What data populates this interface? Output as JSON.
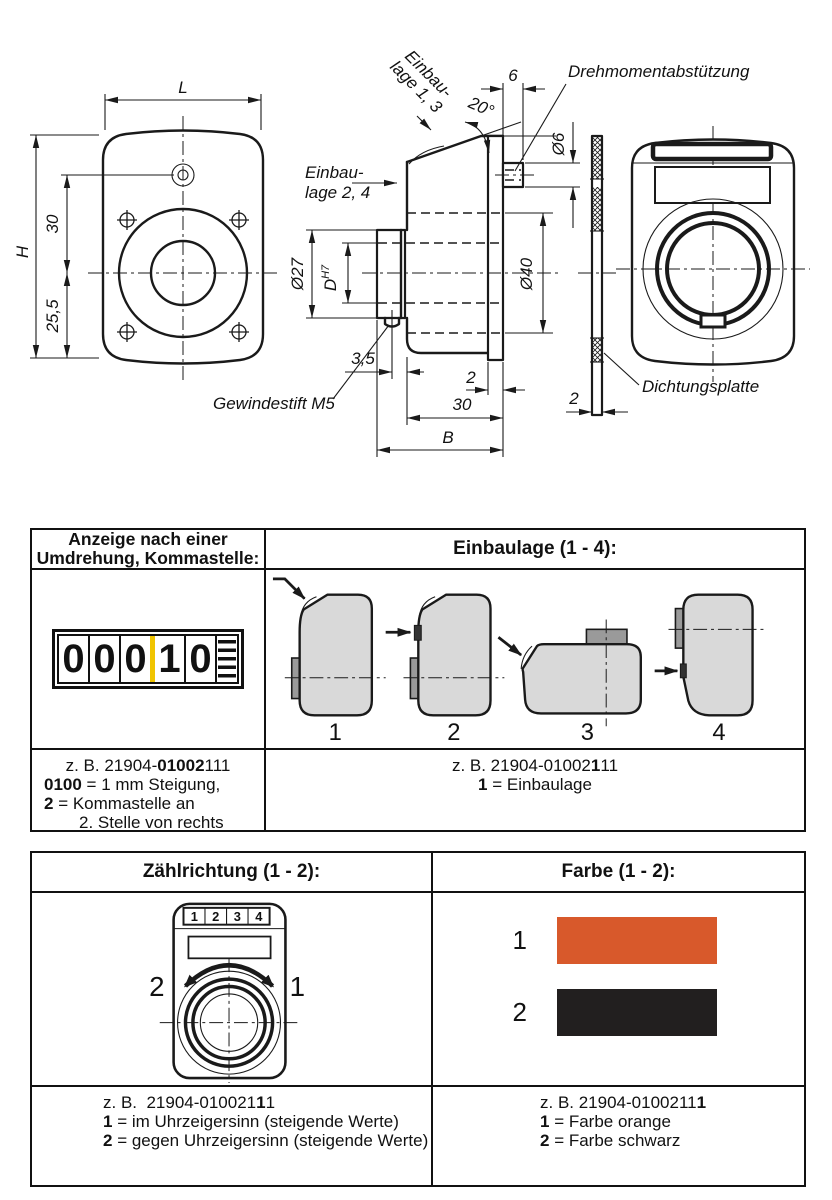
{
  "page": {
    "line_color": "#1a1a1a",
    "background": "#ffffff"
  },
  "drawing": {
    "front": {
      "L": "L",
      "H": "H",
      "d30": "30",
      "d255": "25,5"
    },
    "side": {
      "mount13_l1": "Einbau-",
      "mount13_l2": "lage 1, 3",
      "mount24_l1": "Einbau-",
      "mount24_l2": "lage 2, 4",
      "angle": "20°",
      "w6": "6",
      "torque": "Drehmomentabstützung",
      "d6": "Ø6",
      "d27": "Ø27",
      "D": "D",
      "DH7_sup": "H7",
      "d40": "Ø40",
      "d35": "3,5",
      "setscrew": "Gewindestift M5",
      "t2": "2",
      "d30": "30",
      "B": "B"
    },
    "gasket": {
      "label": "Dichtungsplatte",
      "t2": "2"
    }
  },
  "table1": {
    "header_left_line1": "Anzeige nach einer",
    "header_left_line2": "Umdrehung, Kommastelle:",
    "header_right": "Einbaulage (1 - 4):",
    "counter": {
      "digits": [
        "0",
        "0",
        "0",
        "1",
        "0"
      ],
      "comma_color": "#F0C400"
    },
    "positions": {
      "p1": "1",
      "p2": "2",
      "p3": "3",
      "p4": "4"
    },
    "example_left": {
      "l1a": "z. B. 21904-",
      "l1b": "01002",
      "l1c": "111",
      "l2a": "0100",
      "l2b": " = 1 mm Steigung,",
      "l3a": "2",
      "l3b": " = Kommastelle an",
      "l4": "2. Stelle von rechts"
    },
    "example_right": {
      "l1a": "z. B. 21904-01002",
      "l1b": "1",
      "l1c": "11",
      "l2a": "1",
      "l2b": " = Einbaulage"
    }
  },
  "table2": {
    "header_left": "Zählrichtung (1 - 2):",
    "header_right": "Farbe (1 - 2):",
    "device_digits": {
      "d1": "1",
      "d2": "2",
      "d3": "3",
      "d4": "4"
    },
    "direction": {
      "ccw": "2",
      "cw": "1"
    },
    "colors": {
      "c1": {
        "num": "1",
        "hex": "#D8592B",
        "name": "orange"
      },
      "c2": {
        "num": "2",
        "hex": "#221F1F",
        "name": "schwarz"
      }
    },
    "example_left": {
      "l1a": "z. B.  21904-010021",
      "l1b": "1",
      "l1c": "1",
      "l2a": "1",
      "l2b": " = im Uhrzeigersinn (steigende Werte)",
      "l3a": "2",
      "l3b": " = gegen Uhrzeigersinn (steigende Werte)"
    },
    "example_right": {
      "l1a": "z. B. 21904-0100211",
      "l1b": "1",
      "l2a": "1",
      "l2b": " = Farbe orange",
      "l3a": "2",
      "l3b": " = Farbe schwarz"
    }
  }
}
